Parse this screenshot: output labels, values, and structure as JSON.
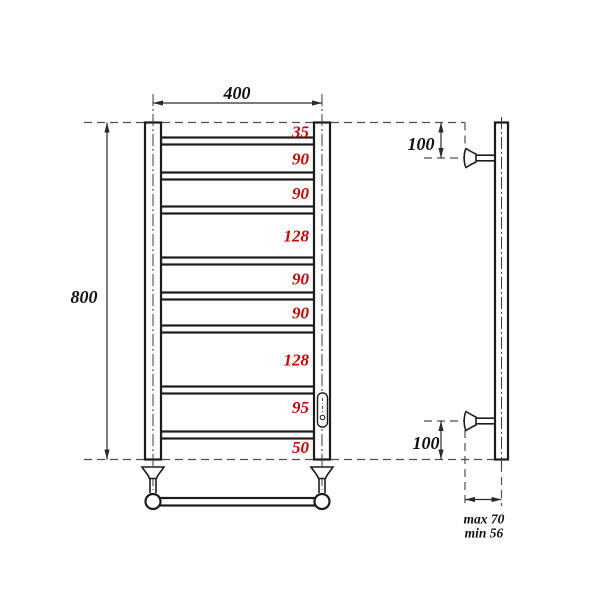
{
  "drawing": {
    "front_view": {
      "width_dim": "400",
      "height_dim": "800",
      "rung_spacings": [
        "35",
        "90",
        "90",
        "128",
        "90",
        "90",
        "128",
        "95",
        "50"
      ],
      "rung_spacings_mm": [
        35,
        90,
        90,
        128,
        90,
        90,
        128,
        95,
        50
      ],
      "rung_count": 8
    },
    "side_view": {
      "top_bracket_offset": "100",
      "bottom_bracket_offset": "100",
      "wall_clearance_max": "max 70",
      "wall_clearance_min": "min 56"
    },
    "colors": {
      "line": "#1c1c1c",
      "dashed_line": "#4f4f4f",
      "spacing_text": "#cc0000",
      "dim_text": "#111111",
      "background": "#ffffff"
    }
  }
}
